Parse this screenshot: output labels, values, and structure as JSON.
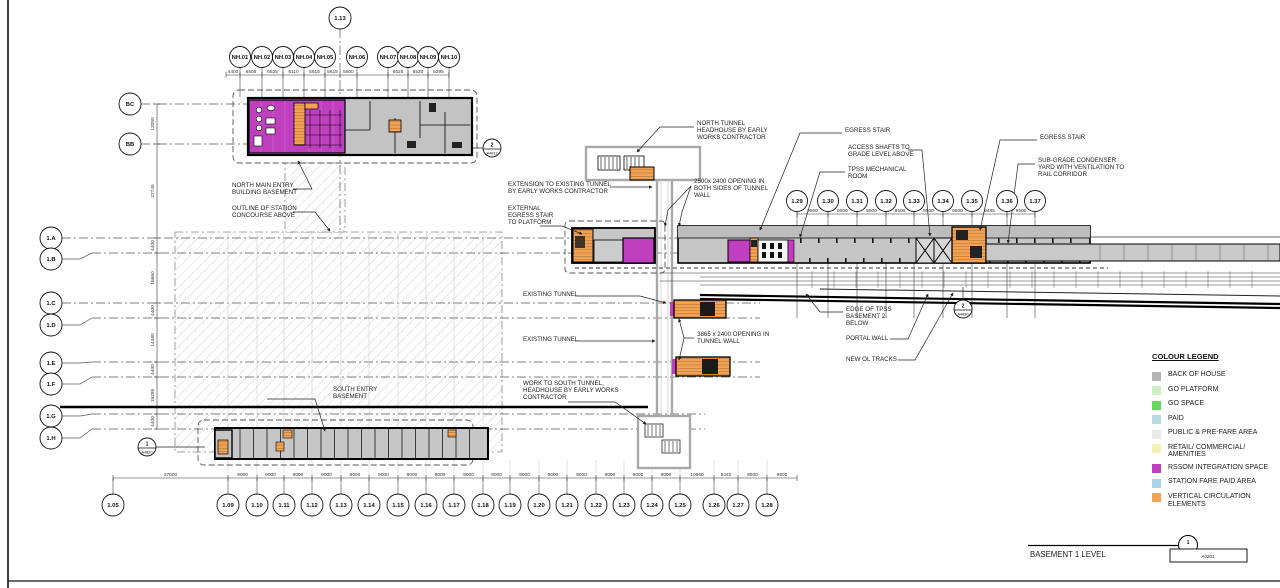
{
  "sheet": {
    "title": "BASEMENT 1 LEVEL",
    "mark": {
      "number": "1",
      "sheet": "A0201"
    }
  },
  "legend": {
    "title": "COLOUR LEGEND",
    "items": [
      {
        "name": "back-of-house",
        "label": "BACK OF HOUSE",
        "color": "#b4b4b4"
      },
      {
        "name": "go-platform",
        "label": "GO PLATFORM",
        "color": "#cdeec6"
      },
      {
        "name": "go-space",
        "label": "GO SPACE",
        "color": "#66d75f"
      },
      {
        "name": "paid",
        "label": "PAID",
        "color": "#b9d8e2"
      },
      {
        "name": "public-pre-fare",
        "label": "PUBLIC & PRE-FARE AREA",
        "color": "#e9e9e9"
      },
      {
        "name": "retail-commercial",
        "label": "RETAIL/ COMMERCIAL/ AMENITIES",
        "color": "#f4f1b4"
      },
      {
        "name": "rssom-integration",
        "label": "RSSOM INTEGRATION SPACE",
        "color": "#c13ec1"
      },
      {
        "name": "station-fare-paid",
        "label": "STATION FARE PAID AREA",
        "color": "#a8d4e6"
      },
      {
        "name": "vertical-circulation",
        "label": "VERTICAL CIRCULATION ELEMENTS",
        "color": "#f2a255"
      }
    ]
  },
  "grids": {
    "nh_row": [
      "NH.01",
      "NH.02",
      "NH.03",
      "NH.04",
      "NH.05",
      "NH.06",
      "NH.07",
      "NH.08",
      "NH.09",
      "NH.10"
    ],
    "top_center": "1.13",
    "left_upper": [
      "BC",
      "BB"
    ],
    "left_row": [
      "1.A",
      "1.B",
      "1.C",
      "1.D",
      "1.E",
      "1.F",
      "1.G",
      "1.H"
    ],
    "right_row": [
      "1.29",
      "1.30",
      "1.31",
      "1.32",
      "1.33",
      "1.34",
      "1.35",
      "1.36",
      "1.37"
    ],
    "bottom_row": [
      "1.05",
      "1.09",
      "1.10",
      "1.11",
      "1.12",
      "1.13",
      "1.14",
      "1.15",
      "1.16",
      "1.17",
      "1.18",
      "1.19",
      "1.20",
      "1.21",
      "1.22",
      "1.23",
      "1.24",
      "1.25",
      "1.26",
      "1.27",
      "1.28"
    ],
    "dims": {
      "top": [
        "4400",
        "6505",
        "6525",
        "6110",
        "5615",
        "5615",
        "5800",
        "",
        "6525",
        "6520",
        "5295"
      ],
      "left": [
        "12050",
        "27745",
        "4400",
        "16660",
        "4400",
        "14480",
        "4400",
        "15295",
        "4400"
      ],
      "right": [
        "9500",
        "9500",
        "9500",
        "9500",
        "9500",
        "9500",
        "9485",
        "9500"
      ],
      "bottom": [
        "37000",
        "9000",
        "9000",
        "9000",
        "9000",
        "9000",
        "9000",
        "9000",
        "9000",
        "9000",
        "9000",
        "9000",
        "9000",
        "9000",
        "9000",
        "9000",
        "9000",
        "10660",
        "8340",
        "9500",
        "9500"
      ]
    }
  },
  "markers": [
    {
      "id": "m-north",
      "number": "2",
      "sheet": "A4811"
    },
    {
      "id": "m-south",
      "number": "1",
      "sheet": "A4820"
    },
    {
      "id": "m-track",
      "number": "2",
      "sheet": "A4630"
    }
  ],
  "annotations": {
    "north_headhouse": [
      "NORTH TUNNEL",
      "HEADHOUSE BY EARLY",
      "WORKS CONTRACTOR"
    ],
    "opening_both": [
      "2500x 2400 OPENING IN",
      "BOTH SIDES OF TUNNEL",
      "WALL"
    ],
    "extension_tunnel": [
      "EXTENSION TO EXISTING TUNNEL",
      "BY EARLY WORKS CONTRACTOR"
    ],
    "external_egress": [
      "EXTERNAL",
      "EGRESS STAIR",
      "TO PLATFORM"
    ],
    "egress_stair_1": [
      "EGRESS STAIR"
    ],
    "access_shafts": [
      "ACCESS SHAFTS TO",
      "GRADE LEVEL ABOVE"
    ],
    "tpss_room": [
      "TPSS MECHANICAL",
      "ROOM"
    ],
    "egress_stair_2": [
      "EGRESS STAIR"
    ],
    "condenser_yard": [
      "SUB-GRADE CONDENSER",
      "YARD WITH VENTILATION TO",
      "RAIL CORRIDOR"
    ],
    "north_main_entry": [
      "NORTH MAIN ENTRY",
      "BUILDING BASEMENT"
    ],
    "concourse_outline": [
      "OUTLINE OF STATION",
      "CONCOURSE ABOVE"
    ],
    "existing_tunnel_1": [
      "EXISTING TUNNEL"
    ],
    "existing_tunnel_2": [
      "EXISTING TUNNEL"
    ],
    "opening_tunnel_wall": [
      "3865 x 2400 OPENING IN",
      "TUNNEL WALL"
    ],
    "work_south_tunnel": [
      "WORK TO SOUTH TUNNEL,",
      "HEADHOUSE BY EARLY WORKS",
      "CONTRACTOR"
    ],
    "south_entry": [
      "SOUTH ENTRY",
      "BASEMENT"
    ],
    "edge_tpss": [
      "EDGE OF TPSS",
      "BASEMENT 2",
      "BELOW"
    ],
    "portal_wall": [
      "PORTAL WALL"
    ],
    "new_ol_tracks": [
      "NEW OL TRACKS"
    ]
  }
}
